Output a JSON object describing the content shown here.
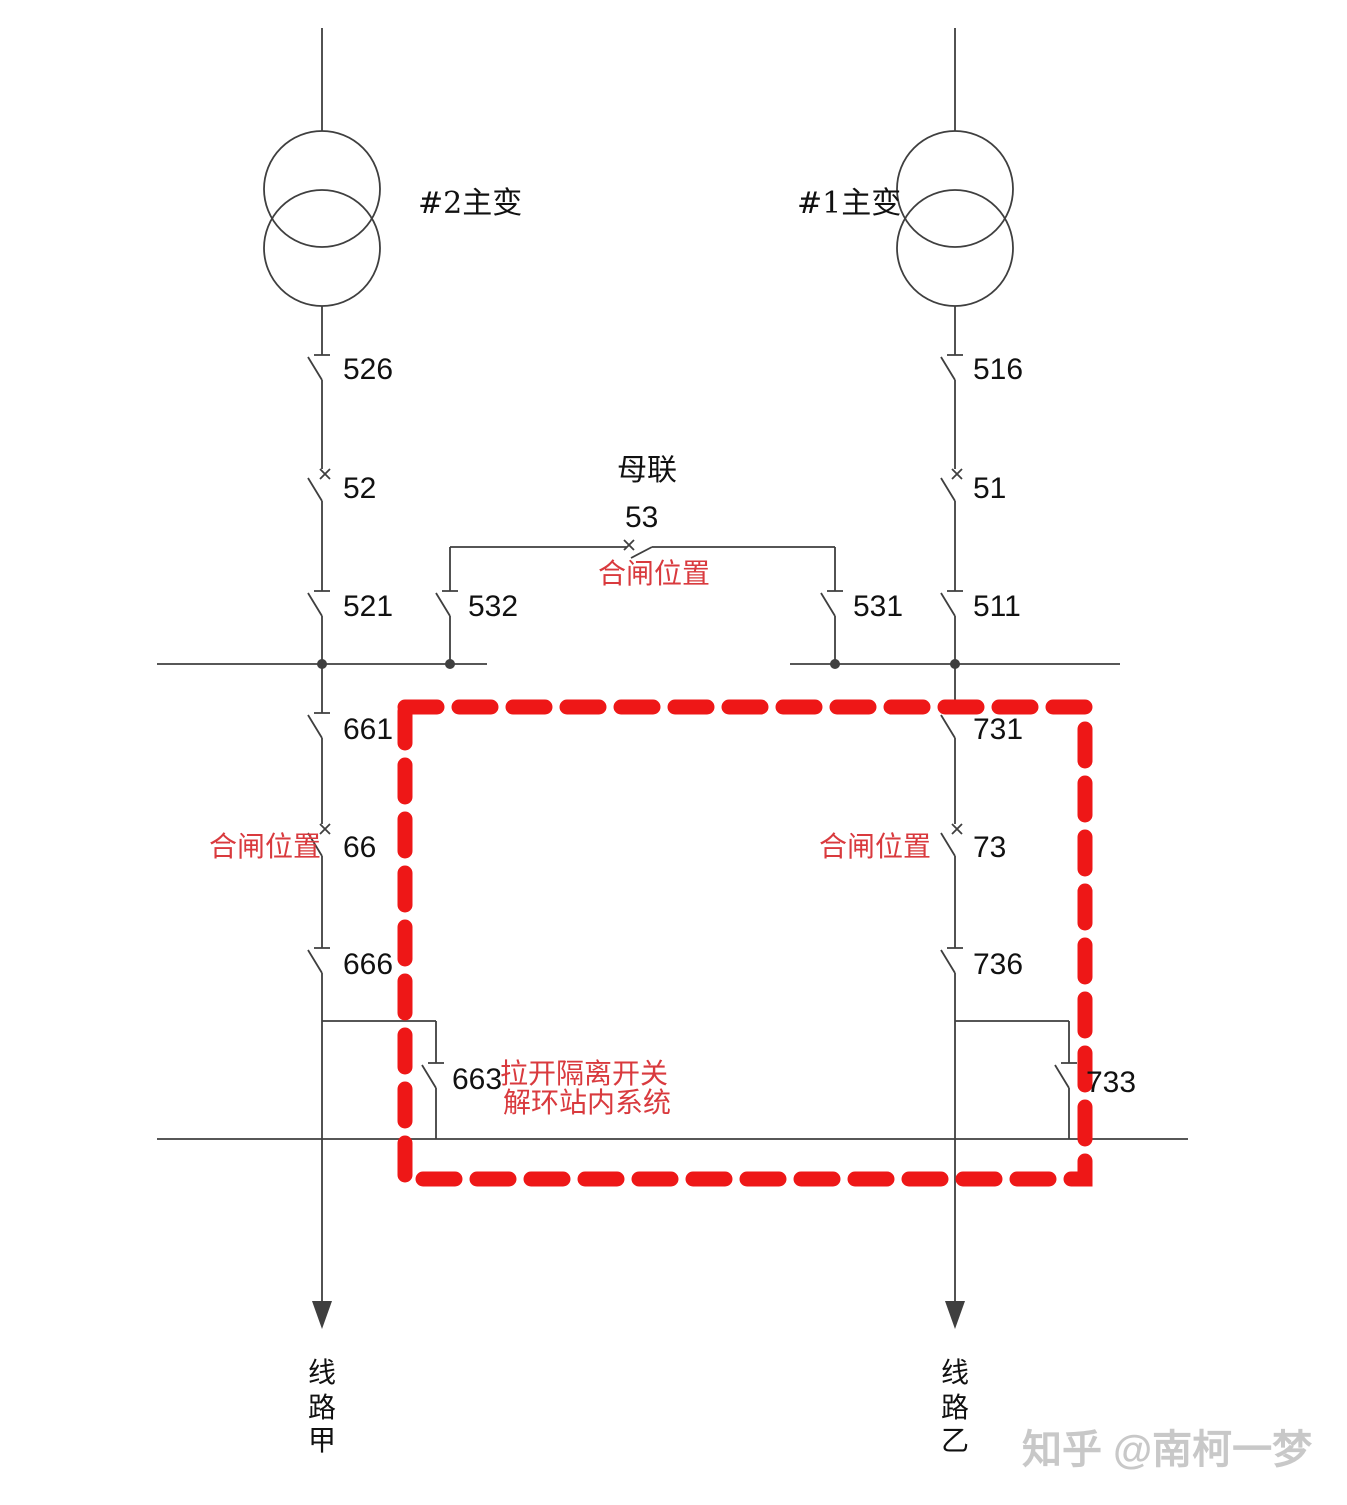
{
  "colors": {
    "line": "#3f3f3f",
    "text": "#111111",
    "red-dash": "#ee1717",
    "red-text": "#d93a3e",
    "watermark": "#c8c8c8",
    "background": "#ffffff"
  },
  "transformers": {
    "t2": "#2主变",
    "t1": "#1主变"
  },
  "bus_tie": {
    "name": "母联",
    "breaker": "53"
  },
  "switches": {
    "s526": "526",
    "s52": "52",
    "s521": "521",
    "s516": "516",
    "s51": "51",
    "s511": "511",
    "s532": "532",
    "s531": "531",
    "s661": "661",
    "s66": "66",
    "s666": "666",
    "s731": "731",
    "s73": "73",
    "s736": "736",
    "s663": "663",
    "s733": "733"
  },
  "annotations": {
    "closed_tie": "合闸位置",
    "closed_left": "合闸位置",
    "closed_right": "合闸位置",
    "action_line1": "拉开隔离开关",
    "action_line2": "解环站内系统"
  },
  "feeders": {
    "line_a": "线路甲",
    "line_b": "线路乙"
  },
  "watermark": "知乎 @南柯一梦"
}
